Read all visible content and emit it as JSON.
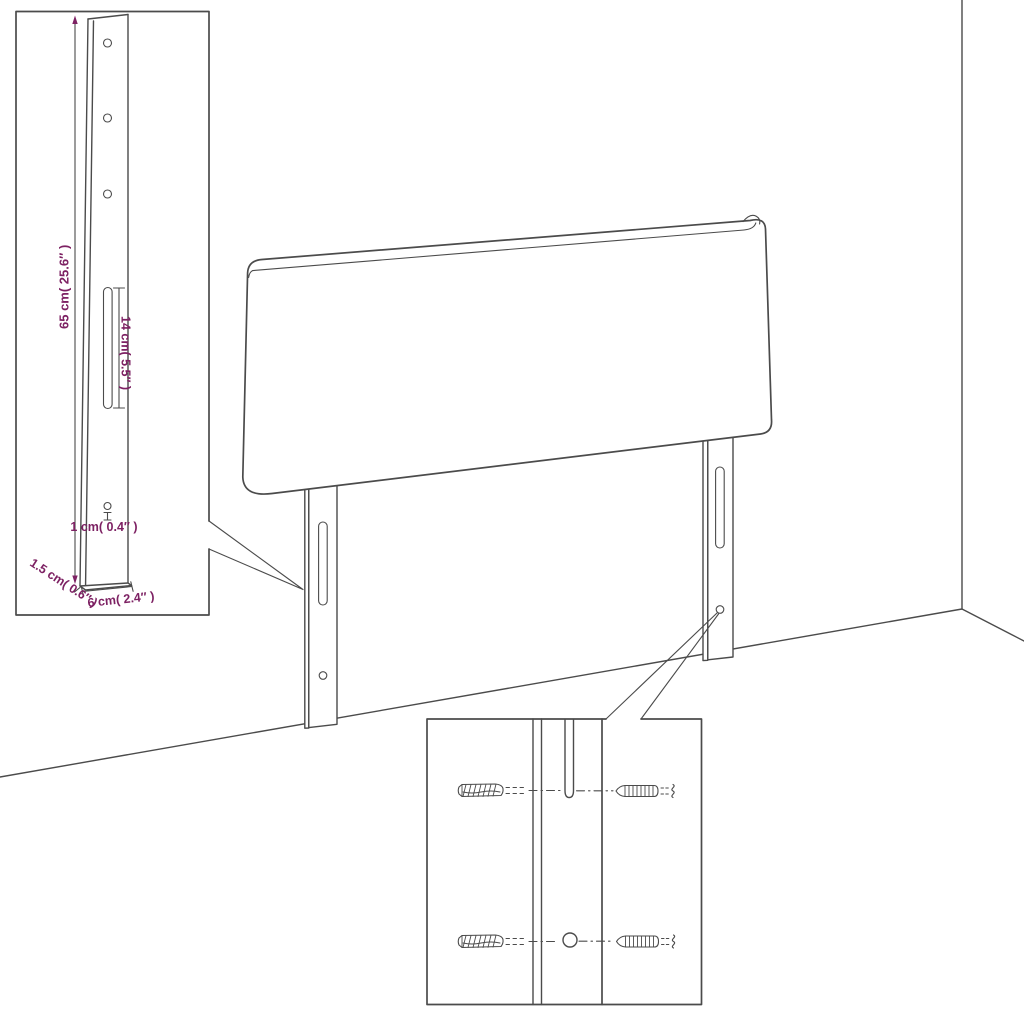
{
  "labels": {
    "height": "65 cm( 25.6″ )",
    "slot_length": "14 cm( 5.5″ )",
    "hole_diameter": "1 cm( 0.4″ )",
    "thickness": "1.5 cm( 0.6″ )",
    "width": "6 cm( 2.4″ )"
  },
  "colors": {
    "background": "#ffffff",
    "line": "#4b4b4b",
    "dimension_text": "#7d2163"
  }
}
